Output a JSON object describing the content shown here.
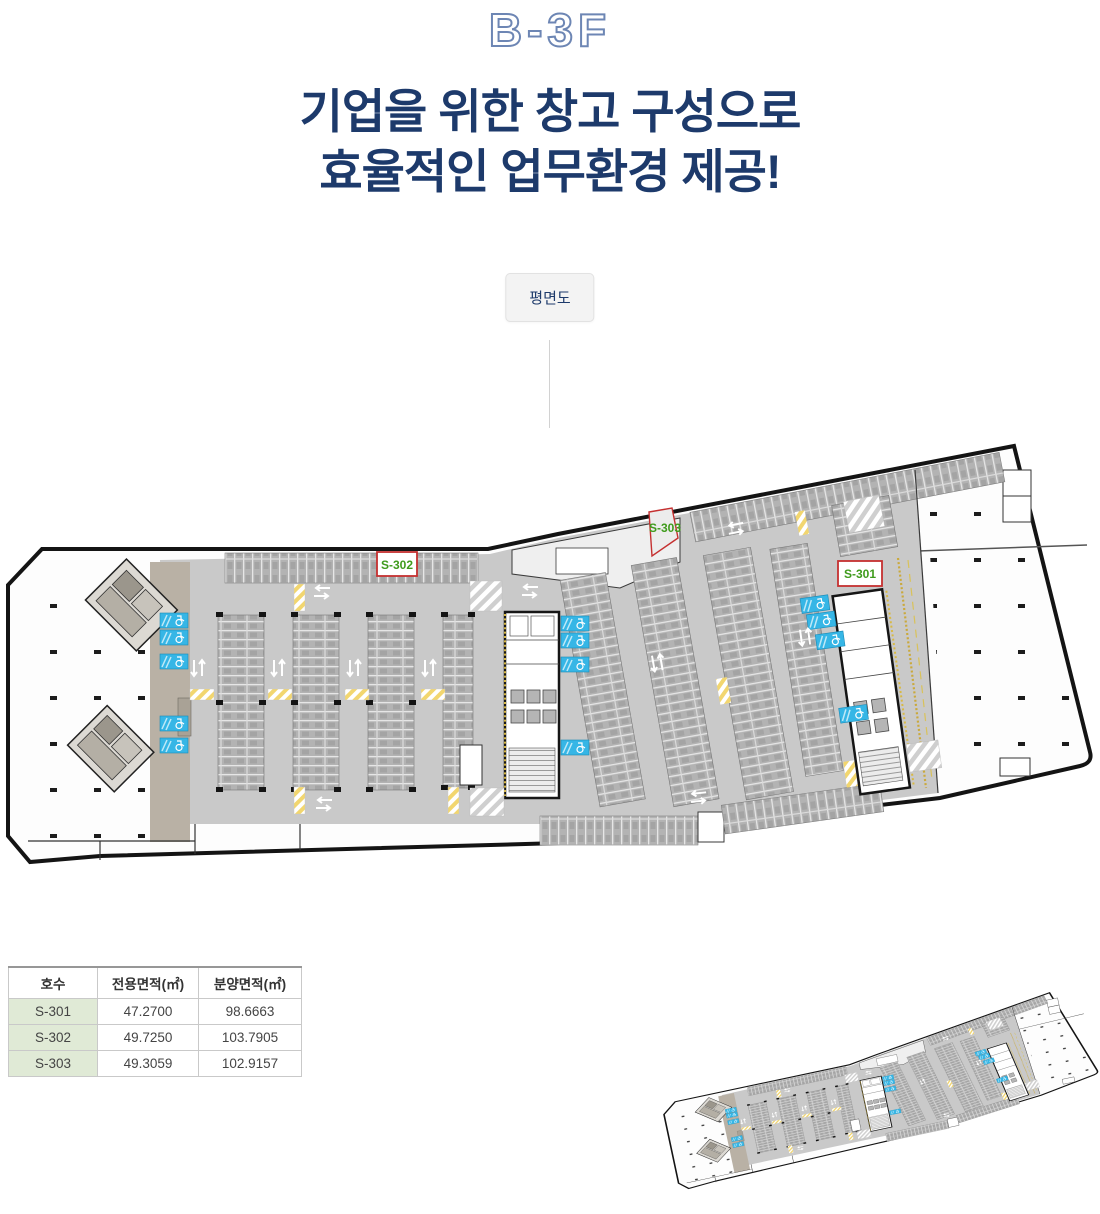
{
  "header": {
    "floor_label": "B-3F",
    "headline_line1": "기업을 위한 창고 구성으로",
    "headline_line2": "효율적인 업무환경 제공!",
    "tab_label": "평면도"
  },
  "plan": {
    "unit_labels": {
      "s301": "S-301",
      "s302": "S-302",
      "s303": "S-303"
    }
  },
  "table": {
    "columns": [
      "호수",
      "전용면적(㎡)",
      "분양면적(㎡)"
    ],
    "rows": [
      {
        "unit": "S-301",
        "exclusive": "47.2700",
        "supply": "98.6663"
      },
      {
        "unit": "S-302",
        "exclusive": "49.7250",
        "supply": "103.7905"
      },
      {
        "unit": "S-303",
        "exclusive": "49.3059",
        "supply": "102.9157"
      }
    ]
  },
  "colors": {
    "navy": "#1d3a6b",
    "title_outline": "#6d86b4",
    "unit_label_green": "#3f9b1c",
    "unit_box_red": "#c53030",
    "accessible_blue": "#36b6e6",
    "deck_gray": "#c9c9c9",
    "table_row_green": "#e0ead6"
  }
}
